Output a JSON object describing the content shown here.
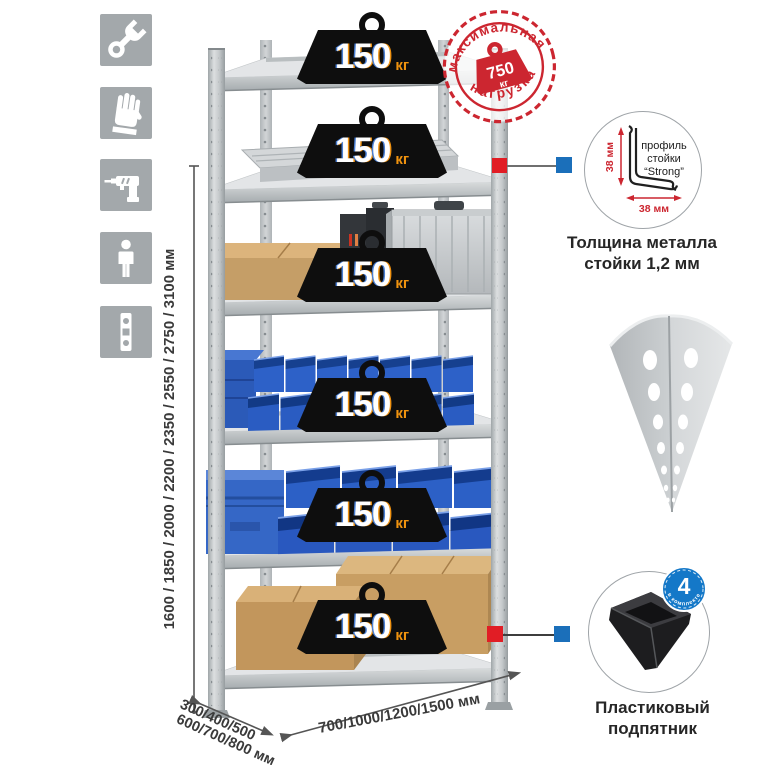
{
  "features": {
    "icons": [
      "wrench-icon",
      "gloves-icon",
      "drill-icon",
      "person-icon",
      "level-icon"
    ]
  },
  "stamp": {
    "arc_top": "максимальная",
    "arc_bottom": "нагрузка",
    "value": "750",
    "unit": "кг"
  },
  "weights": [
    {
      "value": "150",
      "unit": "кг"
    },
    {
      "value": "150",
      "unit": "кг"
    },
    {
      "value": "150",
      "unit": "кг"
    },
    {
      "value": "150",
      "unit": "кг"
    },
    {
      "value": "150",
      "unit": "кг"
    },
    {
      "value": "150",
      "unit": "кг"
    }
  ],
  "dimensions": {
    "height": "1600 / 1850 / 2000 / 2200 / 2350 / 2550 / 2750 / 3100 мм",
    "depth_line1": "300/400/500",
    "depth_line2": "600/700/800 мм",
    "width": "700/1000/1200/1500 мм"
  },
  "profile_detail": {
    "label_line1": "профиль",
    "label_line2": "стойки",
    "label_line3": "“Strong”",
    "vertical_dim": "38 мм",
    "horizontal_dim": "38 мм",
    "caption_line1": "Толщина металла",
    "caption_line2": "стойки 1,2 мм"
  },
  "foot_detail": {
    "badge_value": "4",
    "badge_ring_text": "в комплекте",
    "caption_line1": "Пластиковый",
    "caption_line2": "подпятник"
  },
  "colors": {
    "accent_red": "#cc2630",
    "accent_blue": "#1b6fba",
    "bin_blue": "#2d61c8",
    "icon_gray": "#a3a8ab",
    "kg_orange": "#f0930f"
  }
}
